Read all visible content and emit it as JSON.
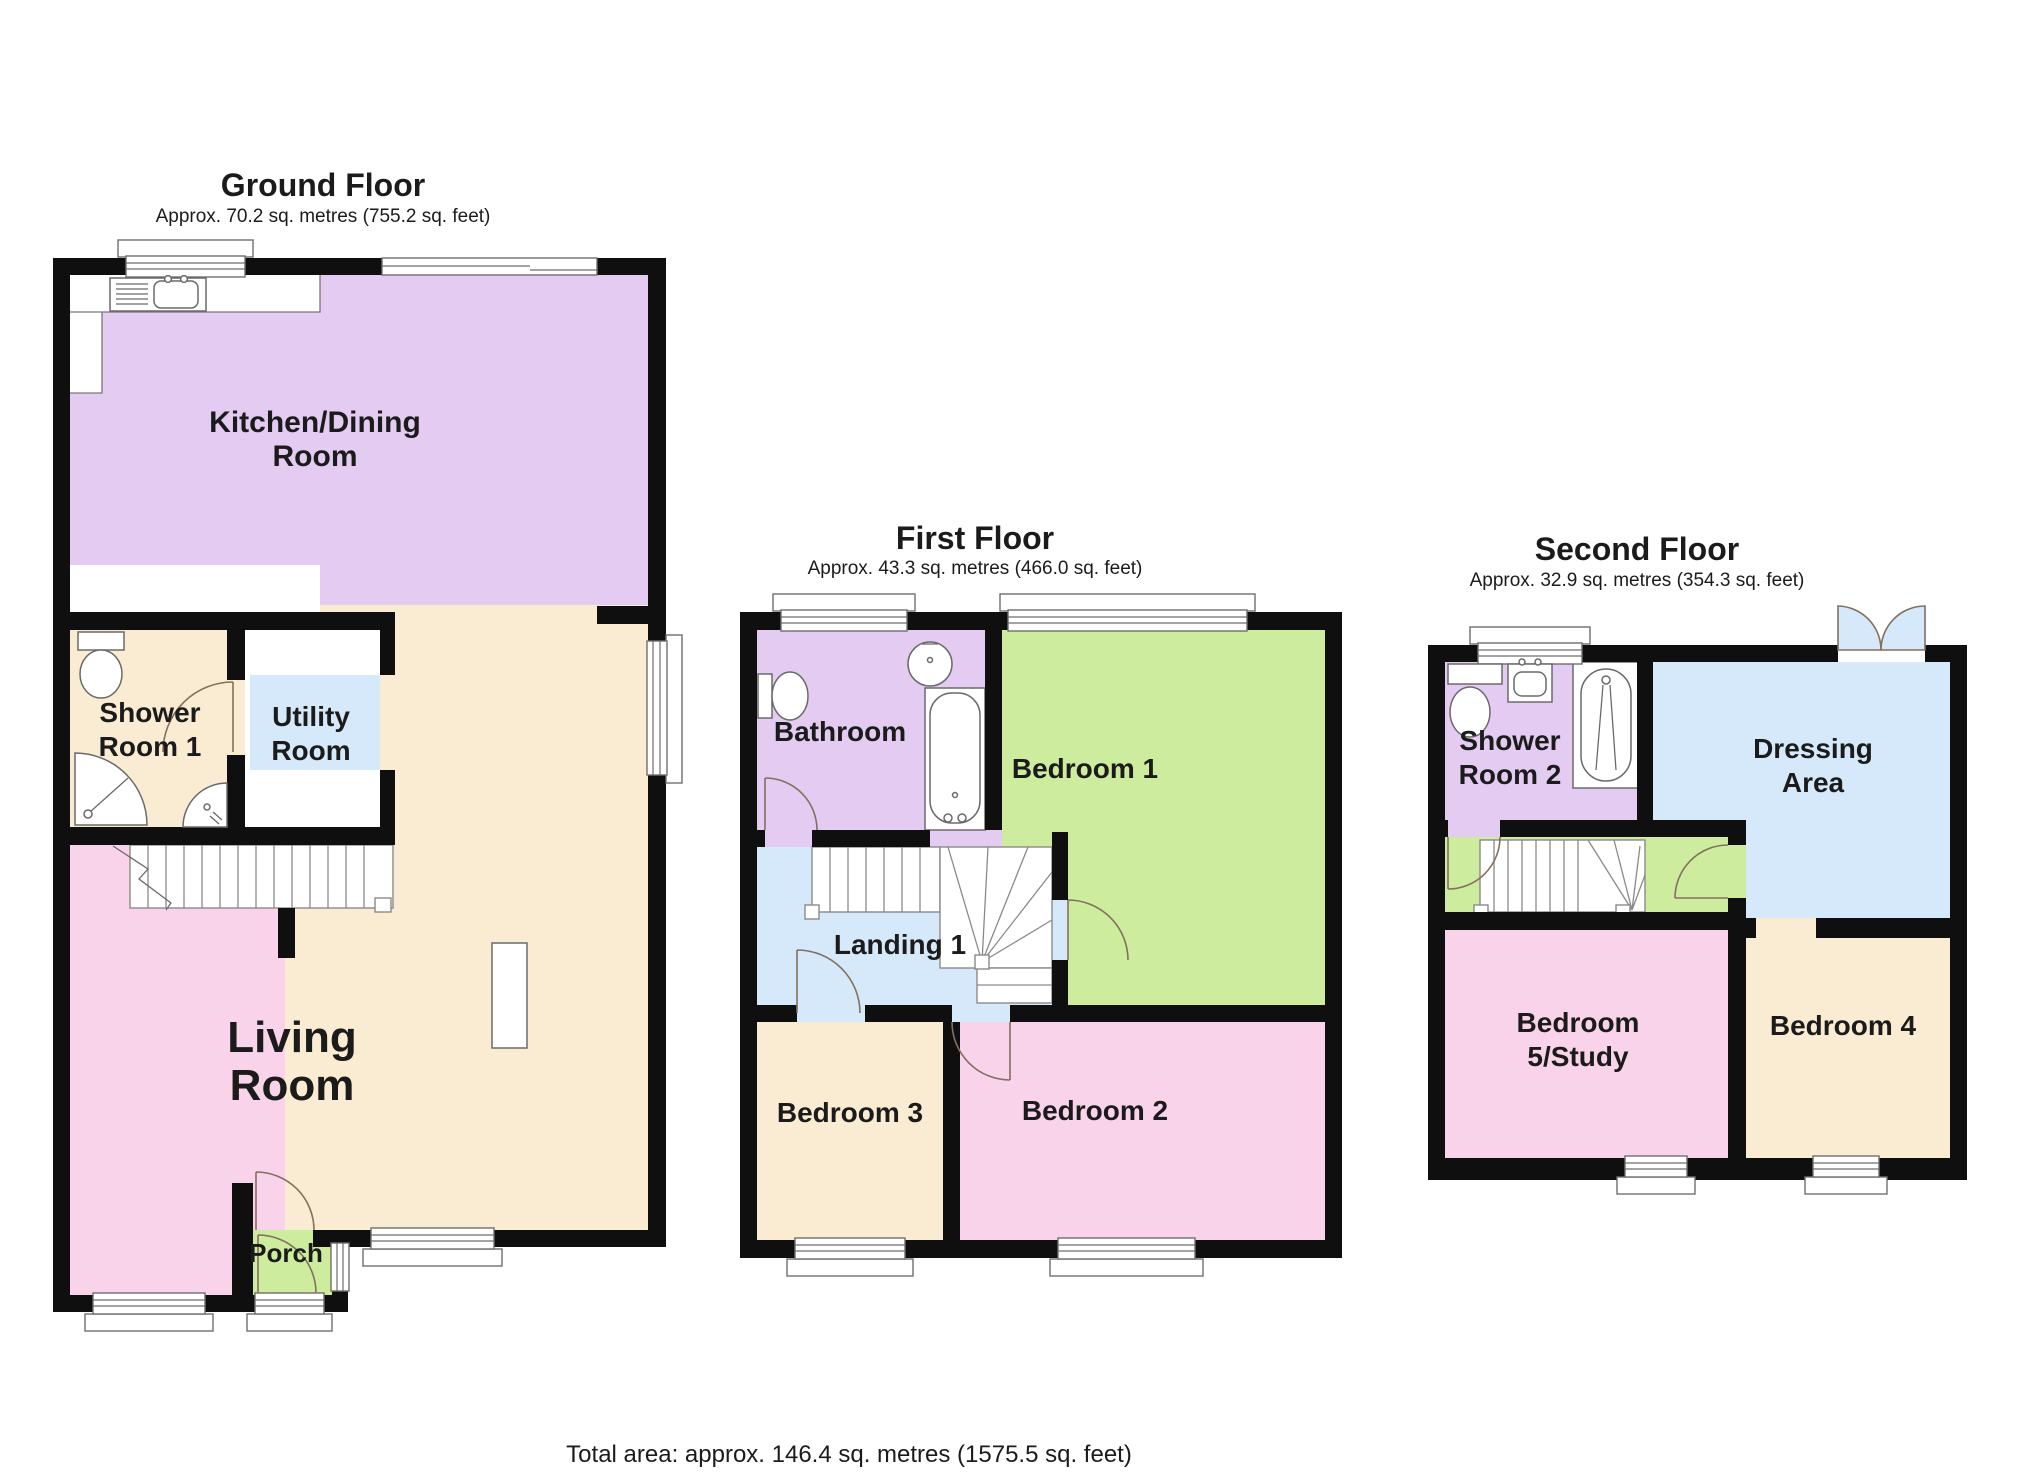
{
  "footer": {
    "text": "Total area: approx. 146.4 sq. metres (1575.5 sq. feet)"
  },
  "colors": {
    "wall": "#0f0f0f",
    "purple": "#e3cbf2",
    "green": "#cdec9e",
    "pink": "#f8d3ea",
    "beige": "#faecd2",
    "blue": "#d6e9fa",
    "white": "#ffffff"
  },
  "floors": {
    "ground": {
      "title": "Ground Floor",
      "subtitle": "Approx. 70.2 sq. metres (755.2 sq. feet)",
      "rooms": {
        "kitchen": {
          "line1": "Kitchen/Dining",
          "line2": "Room"
        },
        "shower1": {
          "line1": "Shower",
          "line2": "Room 1"
        },
        "utility": {
          "line1": "Utility",
          "line2": "Room"
        },
        "living": {
          "line1": "Living",
          "line2": "Room"
        },
        "porch": {
          "line1": "Porch"
        }
      }
    },
    "first": {
      "title": "First Floor",
      "subtitle": "Approx. 43.3 sq. metres (466.0 sq. feet)",
      "rooms": {
        "bathroom": {
          "line1": "Bathroom"
        },
        "bedroom1": {
          "line1": "Bedroom 1"
        },
        "landing": {
          "line1": "Landing 1"
        },
        "bedroom3": {
          "line1": "Bedroom 3"
        },
        "bedroom2": {
          "line1": "Bedroom 2"
        }
      }
    },
    "second": {
      "title": "Second Floor",
      "subtitle": "Approx. 32.9 sq. metres (354.3 sq. feet)",
      "rooms": {
        "shower2": {
          "line1": "Shower",
          "line2": "Room 2"
        },
        "dressing": {
          "line1": "Dressing",
          "line2": "Area"
        },
        "bedroom5": {
          "line1": "Bedroom",
          "line2": "5/Study"
        },
        "bedroom4": {
          "line1": "Bedroom 4"
        }
      }
    }
  }
}
